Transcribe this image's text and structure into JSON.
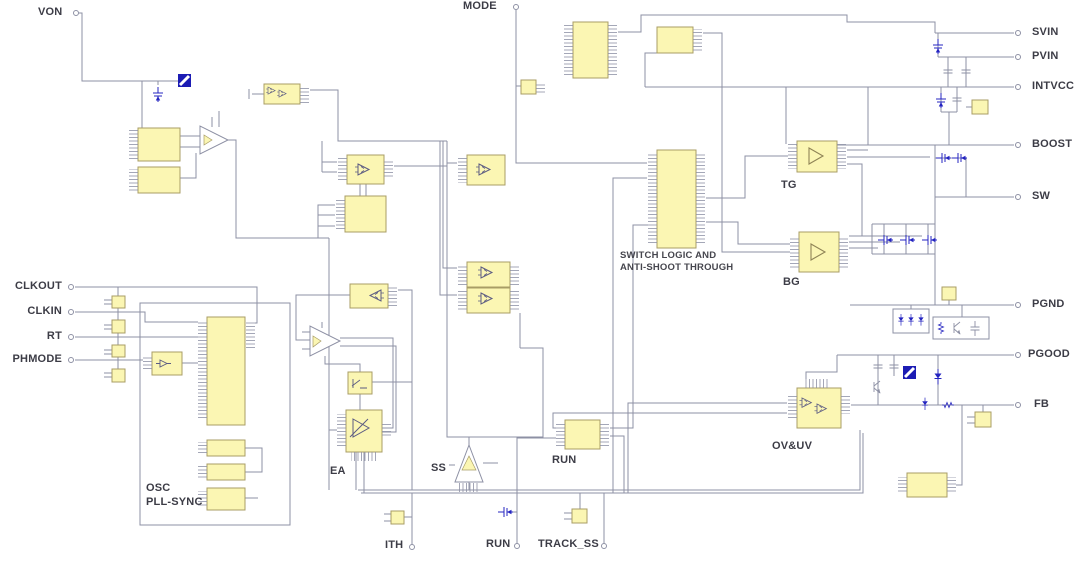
{
  "diagram": {
    "pins": {
      "von": "VON",
      "mode": "MODE",
      "svin": "SVIN",
      "pvin": "PVIN",
      "intvcc": "INTVCC",
      "boost": "BOOST",
      "sw": "SW",
      "pgnd": "PGND",
      "pgood": "PGOOD",
      "fb": "FB",
      "clkout": "CLKOUT",
      "clkin": "CLKIN",
      "rt": "RT",
      "phmode": "PHMODE",
      "ith": "ITH",
      "run": "RUN",
      "track_ss": "TRACK_SS"
    },
    "labels": {
      "tg": "TG",
      "bg": "BG",
      "run_block": "RUN",
      "ea": "EA",
      "ss": "SS",
      "ovuv": "OV&UV",
      "switch_logic_1": "SWITCH LOGIC AND",
      "switch_logic_2": "ANTI-SHOOT THROUGH",
      "osc_1": "OSC",
      "osc_2": "PLL-SYNC"
    },
    "colors": {
      "block_fill": "#fbf6b3",
      "block_border": "#a89d66",
      "wire": "#8d90a4",
      "component_blue": "#2424c0",
      "text": "#3c3c46"
    }
  }
}
